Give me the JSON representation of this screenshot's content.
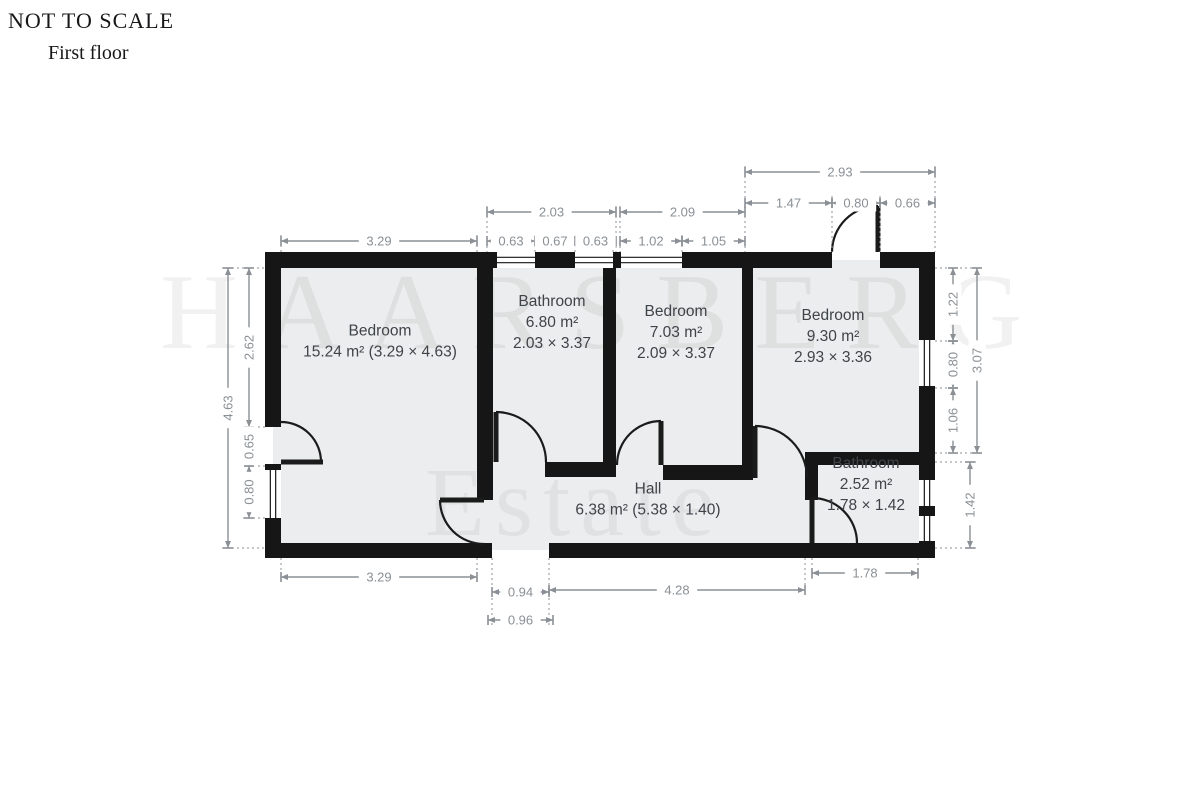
{
  "header": {
    "title": "NOT TO SCALE",
    "subtitle": "First floor"
  },
  "watermark": {
    "line1": "HAARSBERG",
    "line2": "Estate"
  },
  "colors": {
    "wall": "#161616",
    "floor": "#ebedee",
    "dim": "#8a9095",
    "label": "#3f4449",
    "door": "#1b1b1b",
    "background": "#ffffff"
  },
  "plan": {
    "floor": {
      "x": 273,
      "y": 260,
      "w": 654,
      "h": 290
    },
    "rooms": [
      {
        "id": "bedroom-1",
        "lines": [
          "Bedroom",
          "15.24 m² (3.29 × 4.63)"
        ],
        "cx": 380,
        "cy": 341
      },
      {
        "id": "bathroom-1",
        "lines": [
          "Bathroom",
          "6.80 m²",
          "2.03 × 3.37"
        ],
        "cx": 552,
        "cy": 322
      },
      {
        "id": "bedroom-2",
        "lines": [
          "Bedroom",
          "7.03 m²",
          "2.09 × 3.37"
        ],
        "cx": 676,
        "cy": 332
      },
      {
        "id": "bedroom-3",
        "lines": [
          "Bedroom",
          "9.30 m²",
          "2.93 × 3.36"
        ],
        "cx": 833,
        "cy": 336
      },
      {
        "id": "hall",
        "lines": [
          "Hall",
          "6.38 m² (5.38 × 1.40)"
        ],
        "cx": 648,
        "cy": 499
      },
      {
        "id": "bathroom-2",
        "lines": [
          "Bathroom",
          "2.52 m²",
          "1.78 × 1.42"
        ],
        "cx": 866,
        "cy": 484
      }
    ],
    "walls": [
      [
        265,
        252,
        232,
        16
      ],
      [
        535,
        252,
        40,
        16
      ],
      [
        613,
        252,
        8,
        16
      ],
      [
        682,
        252,
        150,
        16
      ],
      [
        880,
        252,
        55,
        16
      ],
      [
        265,
        543,
        227,
        15
      ],
      [
        549,
        543,
        386,
        15
      ],
      [
        265,
        252,
        16,
        175
      ],
      [
        265,
        464,
        16,
        6
      ],
      [
        265,
        518,
        16,
        40
      ],
      [
        919,
        252,
        16,
        88
      ],
      [
        919,
        386,
        16,
        94
      ],
      [
        919,
        506,
        16,
        10
      ],
      [
        919,
        541,
        16,
        17
      ],
      [
        477,
        252,
        16,
        248
      ],
      [
        545,
        462,
        71,
        15
      ],
      [
        603,
        252,
        13,
        211
      ],
      [
        663,
        465,
        79,
        15
      ],
      [
        742,
        252,
        11,
        228
      ],
      [
        805,
        452,
        130,
        13
      ],
      [
        805,
        465,
        13,
        35
      ]
    ],
    "windows": [
      {
        "x": 497,
        "y": 252,
        "w": 38,
        "h": 16,
        "o": "h"
      },
      {
        "x": 575,
        "y": 252,
        "w": 38,
        "h": 16,
        "o": "h"
      },
      {
        "x": 621,
        "y": 252,
        "w": 61,
        "h": 16,
        "o": "h"
      },
      {
        "x": 265,
        "y": 470,
        "w": 16,
        "h": 48,
        "o": "v"
      },
      {
        "x": 919,
        "y": 340,
        "w": 16,
        "h": 46,
        "o": "v"
      },
      {
        "x": 919,
        "y": 480,
        "w": 16,
        "h": 26,
        "o": "v"
      },
      {
        "x": 919,
        "y": 516,
        "w": 16,
        "h": 25,
        "o": "v"
      }
    ],
    "doors": [
      {
        "id": "entry-door-left",
        "leaf": [
          281,
          462,
          323,
          462
        ],
        "arc": "M281,422 A40,40 0 0 1 321,462"
      },
      {
        "id": "bedroom-1-door",
        "leaf": [
          484,
          500,
          440,
          500
        ],
        "arc": "M440,500 A44,44 0 0 0 484,544"
      },
      {
        "id": "bathroom-1-door",
        "leaf": [
          496,
          412,
          496,
          462
        ],
        "arc": "M496,412 A50,50 0 0 1 546,462"
      },
      {
        "id": "bedroom-2-door",
        "leaf": [
          661,
          421,
          661,
          465
        ],
        "arc": "M661,421 A44,44 0 0 0 617,465"
      },
      {
        "id": "bedroom-3-door",
        "leaf": [
          755,
          426,
          755,
          478
        ],
        "arc": "M755,426 A52,52 0 0 1 807,478"
      },
      {
        "id": "balcony-door-top",
        "leaf": [
          878,
          206,
          878,
          252
        ],
        "arc": "M878,206 A46,46 0 0 0 832,252"
      },
      {
        "id": "bathroom-2-door",
        "leaf": [
          812,
          498,
          812,
          543
        ],
        "arc": "M812,498 A45,45 0 0 1 857,543"
      }
    ],
    "dimensions": [
      {
        "label": "2.93",
        "o": "h",
        "x": 745,
        "y": 172,
        "len": 190
      },
      {
        "label": "1.47",
        "o": "h",
        "x": 745,
        "y": 203,
        "len": 87
      },
      {
        "label": "0.80",
        "o": "h",
        "x": 832,
        "y": 203,
        "len": 48
      },
      {
        "label": "0.66",
        "o": "h",
        "x": 880,
        "y": 203,
        "len": 55
      },
      {
        "label": "2.03",
        "o": "h",
        "x": 487,
        "y": 212,
        "len": 129
      },
      {
        "label": "2.09",
        "o": "h",
        "x": 620,
        "y": 212,
        "len": 125
      },
      {
        "label": "3.29",
        "o": "h",
        "x": 281,
        "y": 241,
        "len": 196
      },
      {
        "label": "0.63",
        "o": "h",
        "x": 487,
        "y": 241,
        "len": 48
      },
      {
        "label": "0.67",
        "o": "h",
        "x": 535,
        "y": 241,
        "len": 40
      },
      {
        "label": "0.63",
        "o": "h",
        "x": 575,
        "y": 241,
        "len": 41
      },
      {
        "label": "1.02",
        "o": "h",
        "x": 620,
        "y": 241,
        "len": 62
      },
      {
        "label": "1.05",
        "o": "h",
        "x": 682,
        "y": 241,
        "len": 63
      },
      {
        "label": "4.63",
        "o": "v",
        "x": 228,
        "y": 268,
        "len": 280
      },
      {
        "label": "2.62",
        "o": "v",
        "x": 249,
        "y": 268,
        "len": 159
      },
      {
        "label": "0.65",
        "o": "v",
        "x": 249,
        "y": 427,
        "len": 39
      },
      {
        "label": "0.80",
        "o": "v",
        "x": 249,
        "y": 466,
        "len": 52
      },
      {
        "label": "1.22",
        "o": "v",
        "x": 953,
        "y": 268,
        "len": 73
      },
      {
        "label": "0.80",
        "o": "v",
        "x": 953,
        "y": 341,
        "len": 47
      },
      {
        "label": "1.06",
        "o": "v",
        "x": 953,
        "y": 388,
        "len": 65
      },
      {
        "label": "3.07",
        "o": "v",
        "x": 977,
        "y": 268,
        "len": 185
      },
      {
        "label": "1.42",
        "o": "v",
        "x": 970,
        "y": 462,
        "len": 86
      },
      {
        "label": "3.29",
        "o": "h",
        "x": 281,
        "y": 577,
        "len": 196
      },
      {
        "label": "0.94",
        "o": "h",
        "x": 492,
        "y": 592,
        "len": 57
      },
      {
        "label": "0.96",
        "o": "h",
        "x": 488,
        "y": 620,
        "len": 65
      },
      {
        "label": "4.28",
        "o": "h",
        "x": 549,
        "y": 590,
        "len": 256
      },
      {
        "label": "1.78",
        "o": "h",
        "x": 812,
        "y": 573,
        "len": 106
      }
    ],
    "extensions": [
      [
        745,
        166,
        745,
        252
      ],
      [
        935,
        166,
        935,
        252
      ],
      [
        832,
        196,
        832,
        252
      ],
      [
        880,
        196,
        880,
        252
      ],
      [
        487,
        206,
        487,
        252
      ],
      [
        616,
        206,
        616,
        252
      ],
      [
        620,
        206,
        620,
        252
      ],
      [
        745,
        196,
        745,
        252
      ],
      [
        535,
        235,
        535,
        252
      ],
      [
        575,
        235,
        575,
        252
      ],
      [
        613,
        235,
        613,
        252
      ],
      [
        682,
        235,
        682,
        252
      ],
      [
        281,
        235,
        281,
        252
      ],
      [
        477,
        235,
        477,
        252
      ],
      [
        222,
        268,
        265,
        268
      ],
      [
        222,
        548,
        265,
        548
      ],
      [
        243,
        427,
        265,
        427
      ],
      [
        243,
        466,
        265,
        466
      ],
      [
        243,
        518,
        265,
        518
      ],
      [
        935,
        268,
        983,
        268
      ],
      [
        935,
        453,
        983,
        453
      ],
      [
        935,
        341,
        959,
        341
      ],
      [
        935,
        388,
        959,
        388
      ],
      [
        935,
        462,
        976,
        462
      ],
      [
        935,
        548,
        976,
        548
      ],
      [
        281,
        558,
        281,
        583
      ],
      [
        477,
        558,
        477,
        583
      ],
      [
        492,
        558,
        492,
        626
      ],
      [
        549,
        558,
        549,
        626
      ],
      [
        805,
        558,
        805,
        596
      ],
      [
        812,
        558,
        812,
        579
      ],
      [
        918,
        558,
        918,
        579
      ]
    ]
  }
}
